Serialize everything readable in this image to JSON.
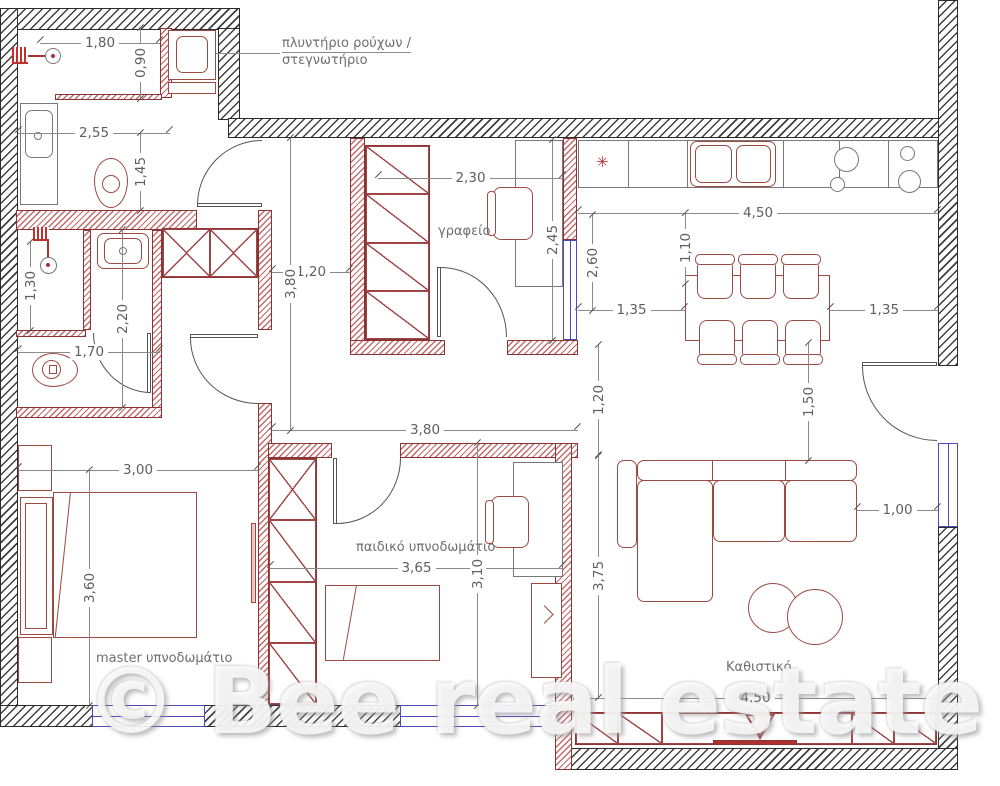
{
  "watermark": {
    "text": "© Bee real estate"
  },
  "rooms": {
    "utility": {
      "label_line1": "πλυντήριο ρούχων /",
      "label_line2": "στεγνωτήριο"
    },
    "office": {
      "label": "γραφείο"
    },
    "kids_bedroom": {
      "label": "παιδικό υπνοδωμάτιο"
    },
    "master_bedroom": {
      "label": "master υπνοδωμάτιο"
    },
    "living_room": {
      "label": "Καθιστικό"
    }
  },
  "symbols": {
    "kitchen_marker": "✳"
  },
  "colors": {
    "exterior_wall": "#3f3f3f",
    "interior_wall": "#c46a6a",
    "window": "#4a4ab8",
    "furniture": "#9c4a42",
    "dimension_text": "#5f5f5f",
    "accent_red": "#b03030"
  },
  "dimensions": {
    "bath1_width": "1,80",
    "utility_depth": "0,90",
    "bath1_inner_width": "2,55",
    "bath1_depth": "1,45",
    "shower2_depth": "1,30",
    "bath2_depth": "2,20",
    "wc_width": "1,70",
    "hall_width": "1,20",
    "hall_length": "3,80",
    "hall_to_living": "3,80",
    "office_width": "2,30",
    "office_depth": "2,45",
    "kitchen_width": "4,50",
    "counter_offset": "1,10",
    "dining_clearance": "2,60",
    "dining_left": "1,35",
    "dining_right": "1,35",
    "entry_clearance": "1,50",
    "living_gap": "1,20",
    "living_depth": "3,75",
    "sofa_clearance": "1,00",
    "living_width": "4,50",
    "master_width": "3,00",
    "master_depth": "3,60",
    "kids_width": "3,65",
    "kids_depth": "3,10"
  }
}
